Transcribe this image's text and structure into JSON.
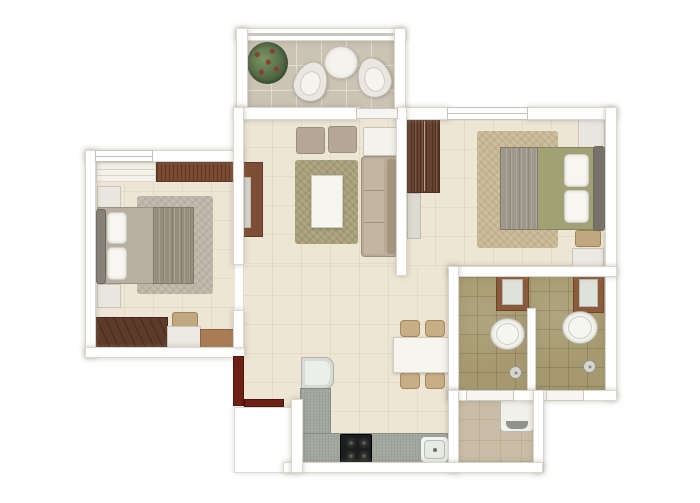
{
  "canvas": {
    "width": 700,
    "height": 503,
    "background": "#ffffff"
  },
  "palette": {
    "wall": "#ffffff",
    "wall_outline": "#dbd7cf",
    "floor_beige": "#eee6d4",
    "floor_balcony": "#cbc3b3",
    "floor_bath_tile": "#a6996f",
    "floor_utility": "#c9bda7",
    "wood_dark": "#6a4330",
    "wood_tv_unit": "#7d4e35",
    "entry_door_red": "#6d2015",
    "sofa_taupe": "#b9ab97",
    "ottoman_taupe": "#b4a795",
    "rug_olive": "#a89e78",
    "rug_tan": "#c6b693",
    "rug_gray": "#bdb5a8",
    "bed_gray": "#b7b0a2",
    "bed_olive": "#a0a175",
    "tan_furniture": "#c8ae86",
    "counter_gray": "#a2a79f",
    "fixture_white": "#f6f6f1",
    "basin_frame_brown": "#8b5a3a",
    "plant_green": "#48603e"
  },
  "elements": [
    {
      "name": "balcony-floor",
      "type": "floor-balcony",
      "x": 246,
      "y": 40,
      "w": 150,
      "h": 70
    },
    {
      "name": "living-room-floor",
      "type": "floor-beige",
      "x": 243,
      "y": 118,
      "w": 155,
      "h": 160
    },
    {
      "name": "dining-kitchen-floor",
      "type": "floor-beige",
      "x": 243,
      "y": 266,
      "w": 209,
      "h": 202
    },
    {
      "name": "bedroom-2-floor",
      "type": "floor-beige",
      "x": 406,
      "y": 120,
      "w": 201,
      "h": 148
    },
    {
      "name": "bedroom-1-floor",
      "type": "floor-beige",
      "x": 95,
      "y": 162,
      "w": 140,
      "h": 188
    },
    {
      "name": "bathroom-1-floor",
      "type": "floor-bath",
      "x": 458,
      "y": 277,
      "w": 72,
      "h": 114
    },
    {
      "name": "bathroom-2-floor",
      "type": "floor-bath",
      "x": 530,
      "y": 272,
      "w": 77,
      "h": 119
    },
    {
      "name": "utility-floor",
      "type": "floor-utility",
      "x": 458,
      "y": 398,
      "w": 77,
      "h": 66
    },
    {
      "name": "living-room-rug",
      "type": "rug-living",
      "x": 295,
      "y": 160,
      "w": 63,
      "h": 84
    },
    {
      "name": "bedroom-2-rug",
      "type": "rug-tan",
      "x": 477,
      "y": 131,
      "w": 81,
      "h": 117
    },
    {
      "name": "bedroom-1-rug",
      "type": "rug-gray",
      "x": 137,
      "y": 196,
      "w": 76,
      "h": 98
    },
    {
      "name": "balcony-plant",
      "type": "plant",
      "x": 247,
      "y": 42,
      "w": 41,
      "h": 42
    },
    {
      "name": "balcony-chair-left",
      "type": "chair-pear",
      "x": 294,
      "y": 61,
      "w": 34,
      "h": 41,
      "rotate": 18
    },
    {
      "name": "balcony-chair-right",
      "type": "chair-pear",
      "x": 357,
      "y": 57,
      "w": 34,
      "h": 41,
      "rotate": -18
    },
    {
      "name": "balcony-round-table",
      "type": "table-round",
      "x": 324,
      "y": 46,
      "w": 34,
      "h": 33
    },
    {
      "name": "tv-console",
      "type": "tv-unit",
      "x": 243,
      "y": 162,
      "w": 20,
      "h": 75
    },
    {
      "name": "tv-screen",
      "type": "tv-screen",
      "x": 244,
      "y": 177,
      "w": 7,
      "h": 51
    },
    {
      "name": "ottoman-left",
      "type": "ottoman",
      "x": 296,
      "y": 127,
      "w": 29,
      "h": 27
    },
    {
      "name": "ottoman-right",
      "type": "ottoman",
      "x": 328,
      "y": 126,
      "w": 29,
      "h": 27
    },
    {
      "name": "living-side-table",
      "type": "side-table",
      "x": 363,
      "y": 127,
      "w": 35,
      "h": 29
    },
    {
      "name": "sofa",
      "type": "sofa",
      "x": 361,
      "y": 156,
      "w": 37,
      "h": 101
    },
    {
      "name": "coffee-table",
      "type": "coffee-table",
      "x": 311,
      "y": 175,
      "w": 32,
      "h": 53
    },
    {
      "name": "dining-chair-top-left",
      "type": "chair-tan",
      "x": 400,
      "y": 320,
      "w": 20,
      "h": 17
    },
    {
      "name": "dining-chair-top-right",
      "type": "chair-tan",
      "x": 425,
      "y": 320,
      "w": 20,
      "h": 17
    },
    {
      "name": "dining-table",
      "type": "dining-table",
      "x": 393,
      "y": 337,
      "w": 59,
      "h": 36
    },
    {
      "name": "dining-chair-bottom-left",
      "type": "chair-tan",
      "x": 400,
      "y": 372,
      "w": 20,
      "h": 17
    },
    {
      "name": "dining-chair-bottom-right",
      "type": "chair-tan",
      "x": 425,
      "y": 372,
      "w": 20,
      "h": 17
    },
    {
      "name": "fridge",
      "type": "fridge",
      "x": 301,
      "y": 357,
      "w": 33,
      "h": 32
    },
    {
      "name": "kitchen-counter-vertical",
      "type": "counter",
      "x": 300,
      "y": 388,
      "w": 31,
      "h": 47
    },
    {
      "name": "kitchen-counter-bottom",
      "type": "counter",
      "x": 300,
      "y": 433,
      "w": 148,
      "h": 30
    },
    {
      "name": "stove-hob",
      "type": "stove",
      "x": 340,
      "y": 434,
      "w": 32,
      "h": 29
    },
    {
      "name": "kitchen-sink",
      "type": "sink",
      "x": 420,
      "y": 436,
      "w": 29,
      "h": 27
    },
    {
      "name": "bathroom-1-washbasin",
      "type": "basin",
      "x": 496,
      "y": 273,
      "w": 33,
      "h": 38
    },
    {
      "name": "bathroom-1-toilet",
      "type": "toilet",
      "x": 490,
      "y": 318,
      "w": 35,
      "h": 32
    },
    {
      "name": "bathroom-1-drain",
      "type": "drain",
      "x": 509,
      "y": 366,
      "w": 13,
      "h": 13
    },
    {
      "name": "bathroom-2-washbasin",
      "type": "basin",
      "x": 573,
      "y": 273,
      "w": 31,
      "h": 40
    },
    {
      "name": "bathroom-2-toilet",
      "type": "toilet",
      "x": 562,
      "y": 311,
      "w": 36,
      "h": 33
    },
    {
      "name": "bathroom-2-drain",
      "type": "drain",
      "x": 583,
      "y": 360,
      "w": 13,
      "h": 13
    },
    {
      "name": "washing-machine",
      "type": "washer",
      "x": 500,
      "y": 398,
      "w": 34,
      "h": 34
    },
    {
      "name": "bedroom-1-window-ledge",
      "type": "window-ledge",
      "x": 96,
      "y": 162,
      "w": 60,
      "h": 20
    },
    {
      "name": "bedroom-1-wood-cabinet",
      "type": "wood-band",
      "x": 156,
      "y": 162,
      "w": 87,
      "h": 20
    },
    {
      "name": "bedroom-1-nightstand-top",
      "type": "nightstand",
      "x": 97,
      "y": 186,
      "w": 24,
      "h": 23
    },
    {
      "name": "bedroom-1-nightstand-bottom",
      "type": "nightstand",
      "x": 97,
      "y": 284,
      "w": 24,
      "h": 24
    },
    {
      "name": "bedroom-1-bed",
      "type": "bed-gray",
      "x": 97,
      "y": 207,
      "w": 97,
      "h": 77
    },
    {
      "name": "bedroom-1-headboard",
      "type": "headboard",
      "x": 96,
      "y": 209,
      "w": 10,
      "h": 75
    },
    {
      "name": "bedroom-1-pillow-top",
      "type": "pillow",
      "x": 107,
      "y": 212,
      "w": 20,
      "h": 32
    },
    {
      "name": "bedroom-1-pillow-bottom",
      "type": "pillow",
      "x": 107,
      "y": 247,
      "w": 20,
      "h": 33
    },
    {
      "name": "bedroom-1-blanket",
      "type": "blanket",
      "x": 153,
      "y": 207,
      "w": 41,
      "h": 77
    },
    {
      "name": "bedroom-1-wardrobe",
      "type": "wardrobe-diag",
      "x": 95,
      "y": 317,
      "w": 73,
      "h": 31
    },
    {
      "name": "bedroom-1-stool",
      "type": "stool-tan",
      "x": 172,
      "y": 312,
      "w": 26,
      "h": 16
    },
    {
      "name": "bedroom-1-dresser-white",
      "type": "dresser-light",
      "x": 167,
      "y": 326,
      "w": 34,
      "h": 23
    },
    {
      "name": "bedroom-1-dresser-wood",
      "type": "dresser-tan",
      "x": 200,
      "y": 329,
      "w": 41,
      "h": 21
    },
    {
      "name": "bedroom-2-wardrobe",
      "type": "wardrobe",
      "x": 407,
      "y": 119,
      "w": 33,
      "h": 74
    },
    {
      "name": "bedroom-2-dresser-panel",
      "type": "panel-light",
      "x": 407,
      "y": 193,
      "w": 14,
      "h": 46
    },
    {
      "name": "bedroom-2-nightstand-top",
      "type": "nightstand",
      "x": 578,
      "y": 117,
      "w": 27,
      "h": 31
    },
    {
      "name": "bedroom-2-bed",
      "type": "bed-olive",
      "x": 500,
      "y": 147,
      "w": 95,
      "h": 83
    },
    {
      "name": "bedroom-2-blanket",
      "type": "blanket",
      "x": 500,
      "y": 147,
      "w": 38,
      "h": 83,
      "color": "#9e988c"
    },
    {
      "name": "bedroom-2-pillow-top",
      "type": "pillow",
      "x": 564,
      "y": 154,
      "w": 25,
      "h": 33
    },
    {
      "name": "bedroom-2-pillow-bottom",
      "type": "pillow",
      "x": 564,
      "y": 190,
      "w": 25,
      "h": 33
    },
    {
      "name": "bedroom-2-headboard",
      "type": "headboard",
      "x": 593,
      "y": 146,
      "w": 12,
      "h": 85,
      "color": "#76726a"
    },
    {
      "name": "bedroom-2-stool",
      "type": "stool-tan",
      "x": 575,
      "y": 230,
      "w": 26,
      "h": 17
    },
    {
      "name": "bedroom-2-bench",
      "type": "bench-light",
      "x": 572,
      "y": 248,
      "w": 32,
      "h": 21
    },
    {
      "name": "wall-balcony-top",
      "type": "wall",
      "x": 236,
      "y": 28,
      "w": 170,
      "h": 13
    },
    {
      "name": "balcony-railing-line",
      "type": "railing",
      "x": 248,
      "y": 33,
      "w": 146,
      "h": 3
    },
    {
      "name": "wall-balcony-left",
      "type": "wall",
      "x": 236,
      "y": 28,
      "w": 12,
      "h": 90
    },
    {
      "name": "wall-balcony-right",
      "type": "wall",
      "x": 394,
      "y": 28,
      "w": 12,
      "h": 92
    },
    {
      "name": "wall-living-top",
      "type": "wall",
      "x": 236,
      "y": 107,
      "w": 124,
      "h": 13
    },
    {
      "name": "wall-bedroom-2-top-left",
      "type": "wall",
      "x": 404,
      "y": 107,
      "w": 46,
      "h": 13
    },
    {
      "name": "wall-bedroom-2-top-right",
      "type": "wall",
      "x": 527,
      "y": 107,
      "w": 90,
      "h": 13
    },
    {
      "name": "wall-right-exterior",
      "type": "wall",
      "x": 605,
      "y": 107,
      "w": 12,
      "h": 293
    },
    {
      "name": "wall-living-bedroom-2",
      "type": "wall",
      "x": 396,
      "y": 107,
      "w": 11,
      "h": 169
    },
    {
      "name": "wall-bedroom-2-bottom",
      "type": "wall",
      "x": 448,
      "y": 266,
      "w": 169,
      "h": 11
    },
    {
      "name": "wall-bathroom-1-left",
      "type": "wall",
      "x": 448,
      "y": 266,
      "w": 11,
      "h": 134
    },
    {
      "name": "wall-bathrooms-divider",
      "type": "wall",
      "x": 527,
      "y": 308,
      "w": 9,
      "h": 92
    },
    {
      "name": "wall-bathrooms-bottom",
      "type": "wall",
      "x": 448,
      "y": 390,
      "w": 169,
      "h": 11
    },
    {
      "name": "wall-utility-left",
      "type": "wall",
      "x": 448,
      "y": 390,
      "w": 11,
      "h": 83
    },
    {
      "name": "wall-utility-right",
      "type": "wall",
      "x": 533,
      "y": 390,
      "w": 11,
      "h": 83
    },
    {
      "name": "wall-bottom-exterior",
      "type": "wall",
      "x": 283,
      "y": 462,
      "w": 260,
      "h": 11
    },
    {
      "name": "wall-kitchen-left",
      "type": "wall",
      "x": 291,
      "y": 399,
      "w": 12,
      "h": 74
    },
    {
      "name": "wall-bedroom-1-top",
      "type": "wall",
      "x": 85,
      "y": 150,
      "w": 158,
      "h": 12
    },
    {
      "name": "wall-bedroom-1-left",
      "type": "wall",
      "x": 85,
      "y": 150,
      "w": 11,
      "h": 208
    },
    {
      "name": "wall-bedroom-1-bottom",
      "type": "wall",
      "x": 85,
      "y": 347,
      "w": 160,
      "h": 11
    },
    {
      "name": "wall-bedroom-1-right-upper",
      "type": "wall",
      "x": 233,
      "y": 107,
      "w": 11,
      "h": 158
    },
    {
      "name": "wall-bedroom-1-right-lower",
      "type": "wall",
      "x": 233,
      "y": 310,
      "w": 11,
      "h": 38
    },
    {
      "name": "bedroom-1-window",
      "type": "window",
      "x": 95,
      "y": 150,
      "w": 58,
      "h": 12
    },
    {
      "name": "bedroom-2-window",
      "type": "window",
      "x": 447,
      "y": 107,
      "w": 81,
      "h": 13
    },
    {
      "name": "balcony-door-sill",
      "type": "sill",
      "x": 356,
      "y": 108,
      "w": 42,
      "h": 11
    },
    {
      "name": "bathroom-1-door-sill",
      "type": "sill",
      "x": 466,
      "y": 390,
      "w": 48,
      "h": 11
    },
    {
      "name": "bathroom-2-door-sill",
      "type": "sill",
      "x": 546,
      "y": 390,
      "w": 38,
      "h": 11
    },
    {
      "name": "entry-door-leaf",
      "type": "door-leaf",
      "x": 233,
      "y": 356,
      "w": 11,
      "h": 50
    },
    {
      "name": "entry-door-swing",
      "type": "door-leaf",
      "x": 244,
      "y": 399,
      "w": 40,
      "h": 8
    },
    {
      "name": "entry-landing-step",
      "type": "landing",
      "x": 234,
      "y": 407,
      "w": 59,
      "h": 66
    }
  ]
}
